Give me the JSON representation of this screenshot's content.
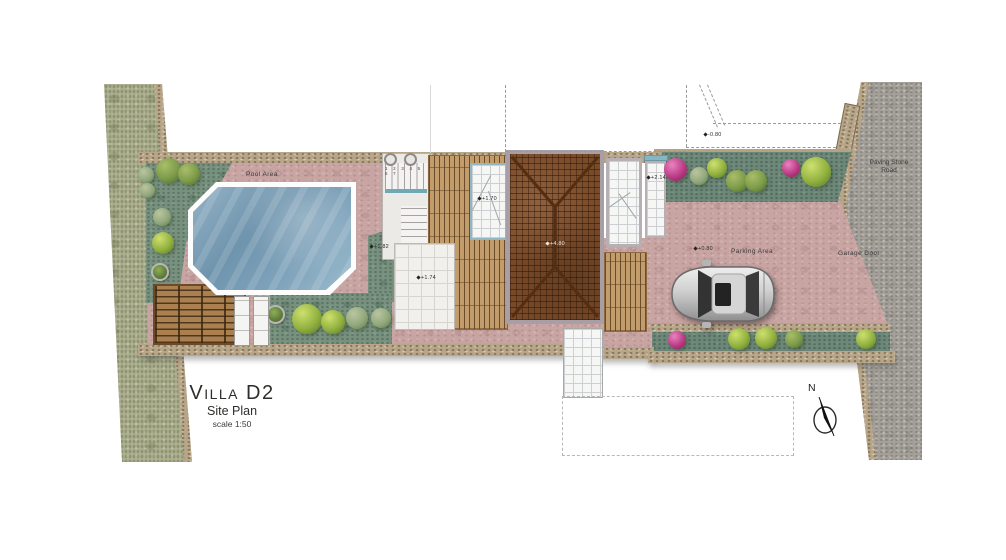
{
  "title_block": {
    "title": "Villa D2",
    "subtitle": "Site Plan",
    "scale": "scale 1:50"
  },
  "labels": {
    "pool_area": "Pool Area",
    "parking_area": "Parking Area",
    "garage_door": "Garage Door",
    "road_name_line1": "Paving Stone",
    "road_name_line2": "Road"
  },
  "compass": {
    "letter": "N"
  },
  "elevation_markers": [
    {
      "text": "+1.70"
    },
    {
      "text": "+1.74"
    },
    {
      "text": "+1.82"
    },
    {
      "text": "+4.80"
    },
    {
      "text": "+0.80"
    },
    {
      "text": "-0.80"
    },
    {
      "text": "+2.14"
    }
  ],
  "stairs": {
    "step_numbers": "1 2 3 4 5 6 7"
  },
  "colors": {
    "c-paving": "#c8a4a2",
    "c-lawn": "#78917f",
    "c-planting": "#6d8779",
    "c-terrain": "#aeb292",
    "c-road": "#a49f98",
    "c-wall": "#b7a68a",
    "c-wood": "#c39c6b",
    "c-pergola": "#ab8050",
    "c-roof": "#7a4b29",
    "c-pool": "#7fa3bb",
    "c-tile": "#f1f0ec",
    "c-pink": "#bb3c86",
    "c-green": "#92b13f",
    "c-olive": "#7d9c49",
    "c-sage": "#93a87c",
    "c-ink": "#2f2d2b"
  }
}
